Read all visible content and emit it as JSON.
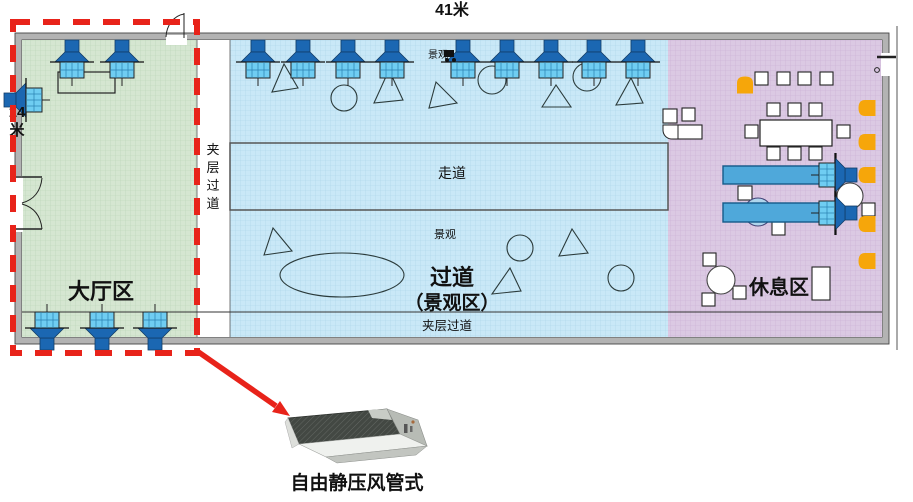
{
  "dimensions": {
    "top_width": "41米",
    "left_height": "14米"
  },
  "regions": {
    "lobby": {
      "label": "大厅区",
      "fill": "#d5e6d1",
      "grid": "#b9d3b6"
    },
    "scenic": {
      "label_line1": "过道",
      "label_line2": "（景观区）",
      "fill": "#c9e8f7",
      "grid": "#a9d4e8"
    },
    "rest": {
      "label": "休息区",
      "fill": "#dbc9e3",
      "grid": "#c9afd3"
    },
    "mezzanine_left": {
      "label": "夹层过道"
    },
    "mezzanine_bottom": {
      "label": "夹层过道"
    }
  },
  "labels": {
    "walkway": "走道",
    "scenic_small_top": "景观",
    "scenic_small_mid": "景观"
  },
  "callout": {
    "unit_label": "自由静压风管式",
    "highlight_color": "#e8231a"
  },
  "equipment": {
    "fan_dark": "#1b67b2",
    "fan_grid": "#6fcdf2",
    "fans": [
      [
        258,
        40,
        0
      ],
      [
        303,
        40,
        0
      ],
      [
        348,
        40,
        0
      ],
      [
        392,
        40,
        0
      ],
      [
        463,
        40,
        0
      ],
      [
        507,
        40,
        0
      ],
      [
        551,
        40,
        0
      ],
      [
        594,
        40,
        0
      ],
      [
        638,
        40,
        0
      ],
      [
        72,
        40,
        0
      ],
      [
        122,
        40,
        0
      ],
      [
        47,
        350,
        180
      ],
      [
        102,
        350,
        180
      ],
      [
        155,
        350,
        180
      ],
      [
        4,
        100,
        -90
      ],
      [
        857,
        175,
        90
      ],
      [
        857,
        213,
        90
      ]
    ],
    "duct_bars": [
      [
        723,
        166,
        114,
        18
      ],
      [
        723,
        203,
        111,
        19
      ]
    ],
    "duct_bar_fill": "#4fa8da",
    "duct_bar_stroke": "#155a8a"
  },
  "landscape": {
    "stroke": "#2b3b3b",
    "triangles": [
      [
        [
          272,
          92
        ],
        [
          284,
          64
        ],
        [
          298,
          88
        ]
      ],
      [
        [
          374,
          103
        ],
        [
          389,
          70
        ],
        [
          403,
          100
        ]
      ],
      [
        [
          429,
          108
        ],
        [
          436,
          82
        ],
        [
          457,
          103
        ]
      ],
      [
        [
          542,
          107
        ],
        [
          556,
          85
        ],
        [
          571,
          107
        ]
      ],
      [
        [
          616,
          105
        ],
        [
          631,
          78
        ],
        [
          643,
          103
        ]
      ],
      [
        [
          264,
          255
        ],
        [
          273,
          228
        ],
        [
          292,
          251
        ]
      ],
      [
        [
          559,
          256
        ],
        [
          572,
          229
        ],
        [
          588,
          253
        ]
      ],
      [
        [
          492,
          294
        ],
        [
          510,
          268
        ],
        [
          521,
          291
        ]
      ]
    ],
    "circles": [
      [
        344,
        98,
        13
      ],
      [
        492,
        80,
        14
      ],
      [
        587,
        77,
        14
      ],
      [
        520,
        248,
        13
      ],
      [
        621,
        278,
        13
      ]
    ],
    "ellipse": {
      "cx": 342,
      "cy": 275,
      "rx": 62,
      "ry": 22
    }
  },
  "furniture": {
    "white_squares": [
      [
        755,
        72,
        13
      ],
      [
        777,
        72,
        13
      ],
      [
        798,
        72,
        13
      ],
      [
        820,
        72,
        13
      ],
      [
        767,
        103,
        13
      ],
      [
        788,
        103,
        13
      ],
      [
        809,
        103,
        13
      ],
      [
        745,
        125,
        13
      ],
      [
        837,
        125,
        13
      ],
      [
        767,
        147,
        13
      ],
      [
        788,
        147,
        13
      ],
      [
        809,
        147,
        13
      ],
      [
        738,
        186,
        14
      ],
      [
        772,
        222,
        13
      ],
      [
        862,
        203,
        13
      ],
      [
        703,
        253,
        13
      ],
      [
        702,
        293,
        13
      ],
      [
        733,
        286,
        13
      ],
      [
        663,
        109,
        14
      ],
      [
        682,
        108,
        13
      ]
    ],
    "white_circles": [
      [
        850,
        196,
        13
      ],
      [
        721,
        280,
        14
      ]
    ],
    "tinted_circle": {
      "cx": 758,
      "cy": 212,
      "r": 14,
      "fill": "#a8d8ee"
    },
    "meeting_table": [
      760,
      120,
      72,
      26
    ],
    "desk_lobby": [
      58,
      72,
      57,
      21
    ],
    "vertical_rect": [
      812,
      267,
      18,
      33
    ],
    "counter_rect": [
      673,
      125,
      29,
      14
    ],
    "orange_color": "#f6a60a",
    "orange_chairs": [
      [
        745,
        85,
        0
      ],
      [
        867,
        108,
        -90
      ],
      [
        867,
        142,
        -90
      ],
      [
        867,
        175,
        -90
      ],
      [
        867,
        224,
        -90
      ],
      [
        867,
        261,
        -90
      ]
    ]
  }
}
